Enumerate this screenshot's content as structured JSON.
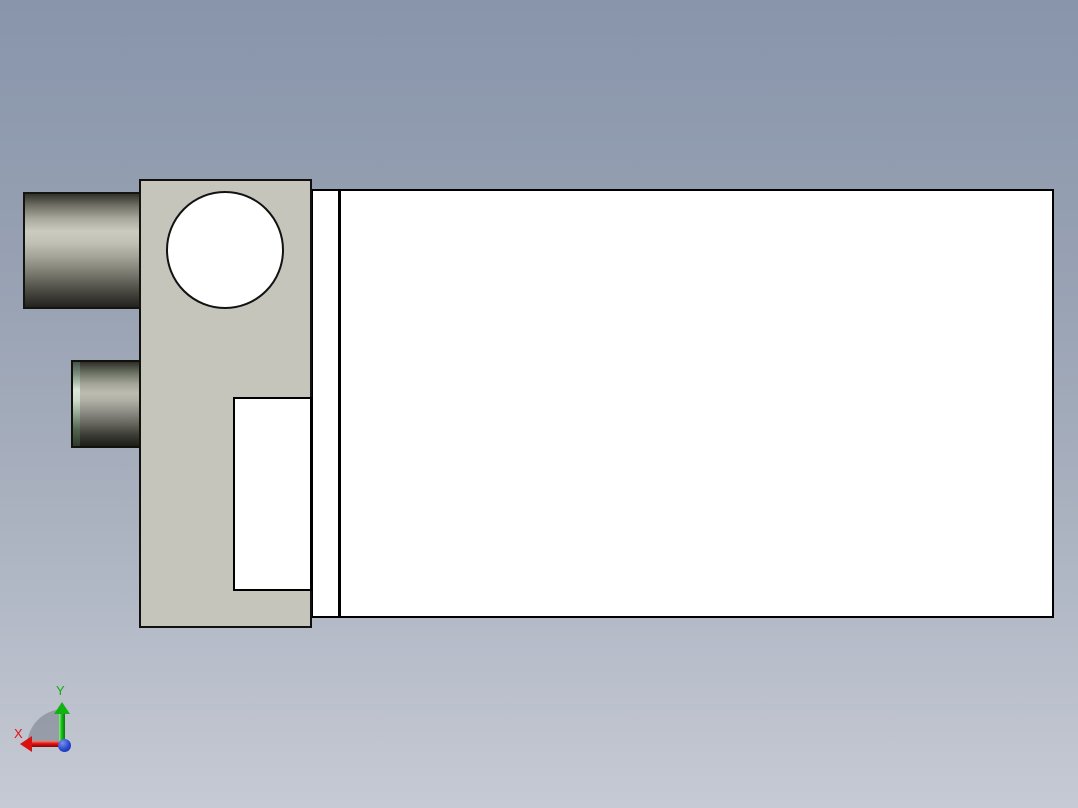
{
  "viewport": {
    "background_top_color": "#8895ab",
    "background_bottom_color": "#c6cad4"
  },
  "model": {
    "main_body_color": "#ffffff",
    "outline_color": "#000000",
    "plate_color": "#c5c5bb",
    "boss_highlight_color": "#cbcbbf",
    "boss_shadow_color": "#232220",
    "boss_cap_tint_color": "#dde8da"
  },
  "axis_triad": {
    "x_label": "X",
    "y_label": "Y",
    "x_color": "#e31111",
    "y_color": "#12b212",
    "z_color": "#2747d0"
  }
}
